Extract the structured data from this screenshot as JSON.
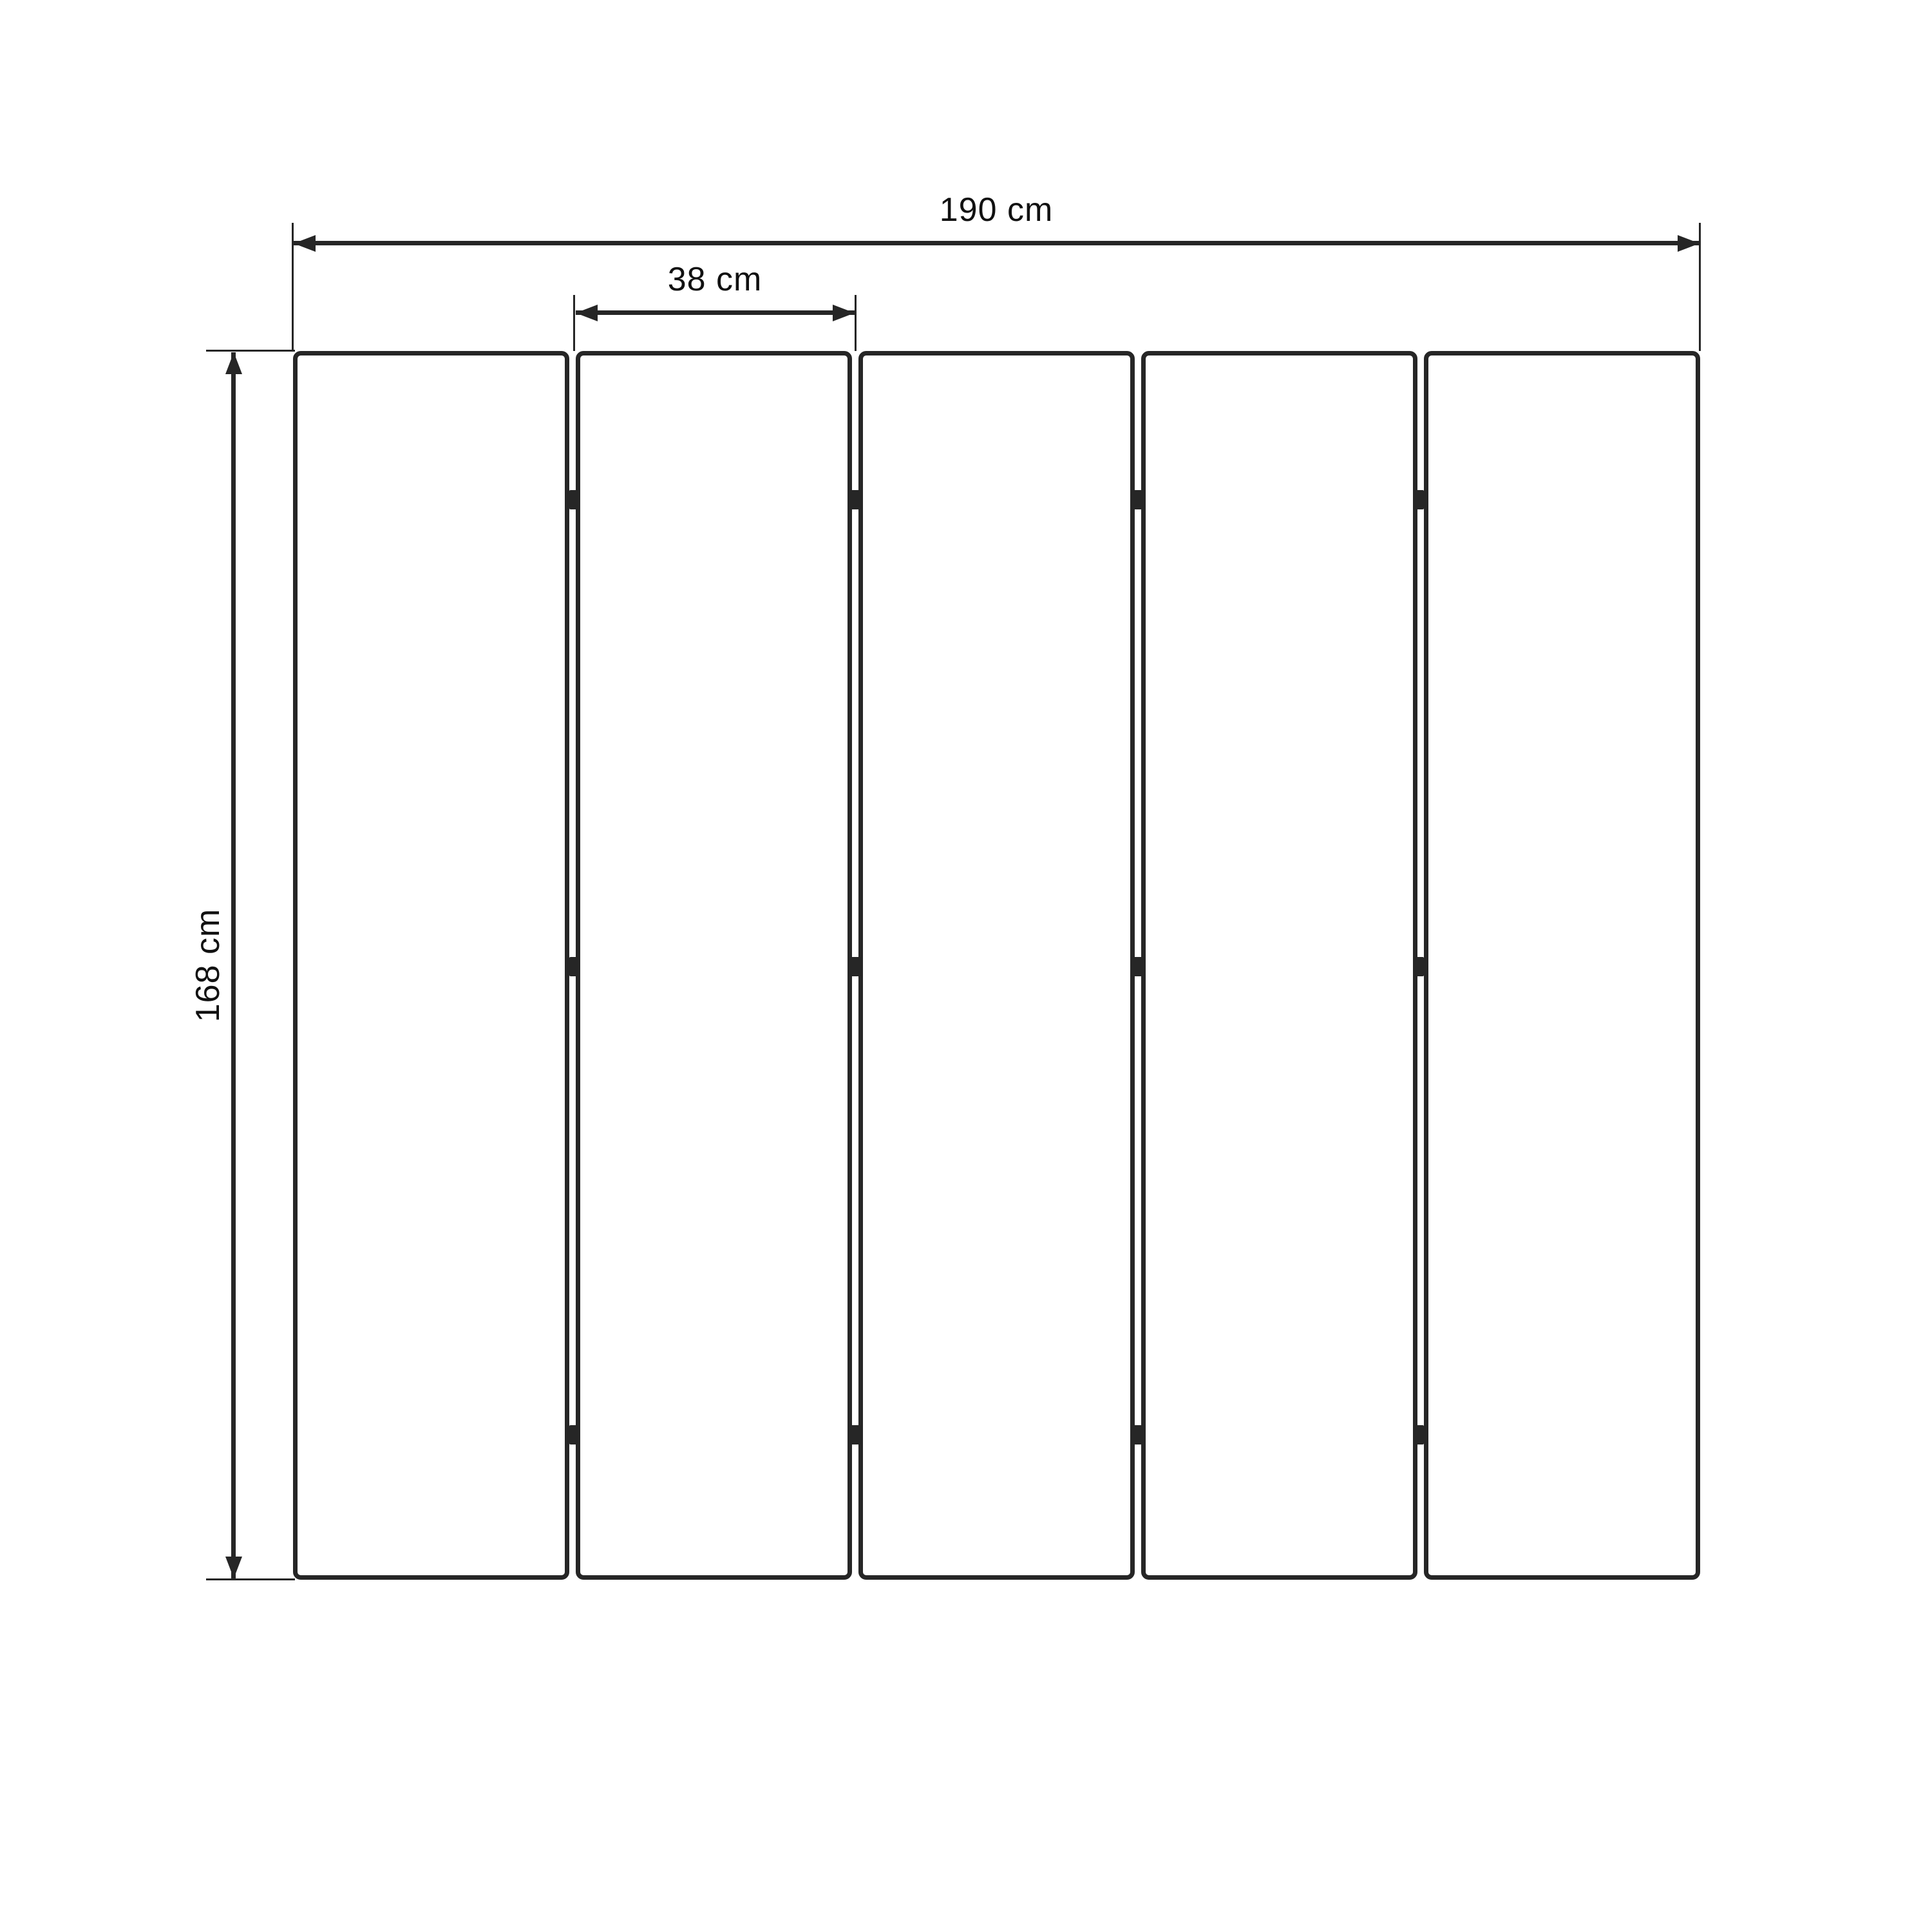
{
  "diagram": {
    "dimensions": {
      "total_width_label": "190 cm",
      "panel_width_label": "38 cm",
      "height_label": "168 cm"
    },
    "structure": {
      "panel_count": 5,
      "hinge_columns": 4,
      "hinge_rows": 3
    },
    "colors": {
      "stroke": "#262626",
      "text": "#111111",
      "background": "#ffffff"
    }
  }
}
